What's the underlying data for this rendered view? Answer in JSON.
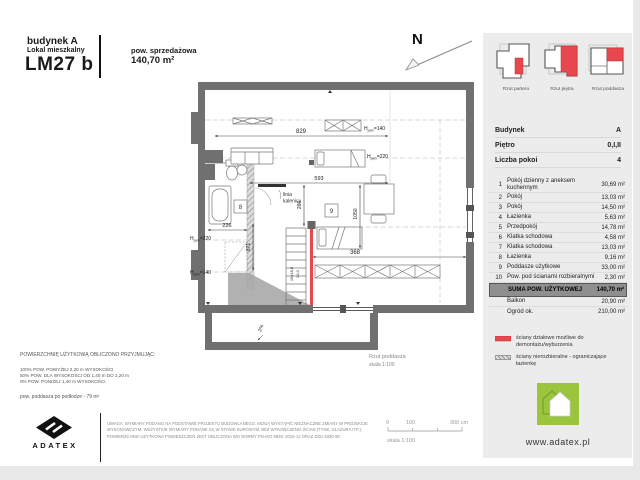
{
  "colors": {
    "red": "#e8474d",
    "green": "#9bc53d",
    "wall": "#707070"
  },
  "header": {
    "building": "budynek A",
    "unit_type": "Lokal mieszkalny",
    "unit_id": "LM27 b",
    "sales_area_label": "pow. sprzedażowa",
    "sales_area_value": "140,70 m²"
  },
  "north_label": "N",
  "sidebar": {
    "views": [
      {
        "label": "Rzut parteru"
      },
      {
        "label": "Rzut piętra"
      },
      {
        "label": "Rzut poddasza"
      }
    ],
    "info": [
      {
        "label": "Budynek",
        "value": "A"
      },
      {
        "label": "Piętro",
        "value": "0,I,II"
      },
      {
        "label": "Liczba pokoi",
        "value": "4"
      }
    ],
    "rooms": [
      {
        "no": "1",
        "name": "Pokój dzienny z aneksem kuchennym",
        "area": "30,69 m²"
      },
      {
        "no": "2",
        "name": "Pokój",
        "area": "13,03 m²"
      },
      {
        "no": "3",
        "name": "Pokój",
        "area": "14,50 m²"
      },
      {
        "no": "4",
        "name": "Łazienka",
        "area": "5,63 m²"
      },
      {
        "no": "5",
        "name": "Przedpokój",
        "area": "14,78 m²"
      },
      {
        "no": "6",
        "name": "Klatka schodowa",
        "area": "4,58 m²"
      },
      {
        "no": "7",
        "name": "Klatka schodowa",
        "area": "13,03 m²"
      },
      {
        "no": "8",
        "name": "Łazienka",
        "area": "9,16 m²"
      },
      {
        "no": "9",
        "name": "Poddasze użytkowe",
        "area": "33,00 m²"
      },
      {
        "no": "10",
        "name": "Pow. pod ścianami rozbieralnymi",
        "area": "2,30 m²"
      }
    ],
    "summary": {
      "label": "SUMA POW. UŻYTKOWEJ",
      "value": "140,70 m²"
    },
    "extras": [
      {
        "label": "Balkon",
        "value": "20,90 m²"
      },
      {
        "label": "Ogród ok.",
        "value": "210,00 m²"
      }
    ],
    "legend": [
      {
        "text": "ściany działowe możliwe do demontażu/wyburzenia"
      },
      {
        "text": "ściany nierozbieralne - ograniczające łazienkę"
      }
    ],
    "website": "www.adatex.pl"
  },
  "plan": {
    "dims": {
      "w829": "829",
      "w593": "593",
      "w226": "226",
      "w368": "368",
      "h266": "266",
      "h1050": "1050",
      "h671": "671"
    },
    "labels": {
      "h": "H",
      "sub": "pom",
      "v140": "=140",
      "v220": "=220",
      "ridge1": "linia",
      "ridge2": "kalenicy",
      "room8": "8",
      "room9": "9",
      "stair1": "16x18,8",
      "stair2": "24,0",
      "slope": "2%"
    },
    "caption": {
      "title": "Rzut poddasza",
      "scale": "skala 1:100"
    }
  },
  "notes": {
    "title": "POWIERZCHNIĘ UŻYTKOWĄ OBLICZONO PRZYJMUJĄC:",
    "rules": [
      "100% POW. POWYŻEJ 2,20 m WYSOKOŚCI",
      "50% POW. DLA WYSOKOŚCI OD 1,40 m DO 2,20 m",
      "0% POW. PONIŻEJ 1,40 m WYSOKOŚCI"
    ],
    "floor_note": "pow. poddasza po podłodze - 79 m²"
  },
  "footer": {
    "brand": "ADATEX",
    "disclaimer": [
      "UWAGA: WYMIARY PODANO NA PODSTAWIE PROJEKTU BUDOWLANEGO. MOGĄ WYSTĄPIĆ NIEZNACZNE ZMIANY W PROJEKCIE",
      "WYKONAWCZYM. WSZYSTKIE WYMIARY PODANE SĄ W STANIE SUROWYM, BEZ WYKOŃCZENIA ŚCIAN (TYNK, GLAZURA ITP.).",
      "POWIERZCHNIA UŻYTKOWA POMIESZCZEŃ JEST OBLICZONA WG NORMY PN-ISO 9836: 2015-12 ORAZ DZU 2020-09."
    ],
    "scalebar": {
      "t0": "0",
      "t100": "100",
      "t300": "300 cm",
      "scale": "skala 1:100"
    }
  }
}
